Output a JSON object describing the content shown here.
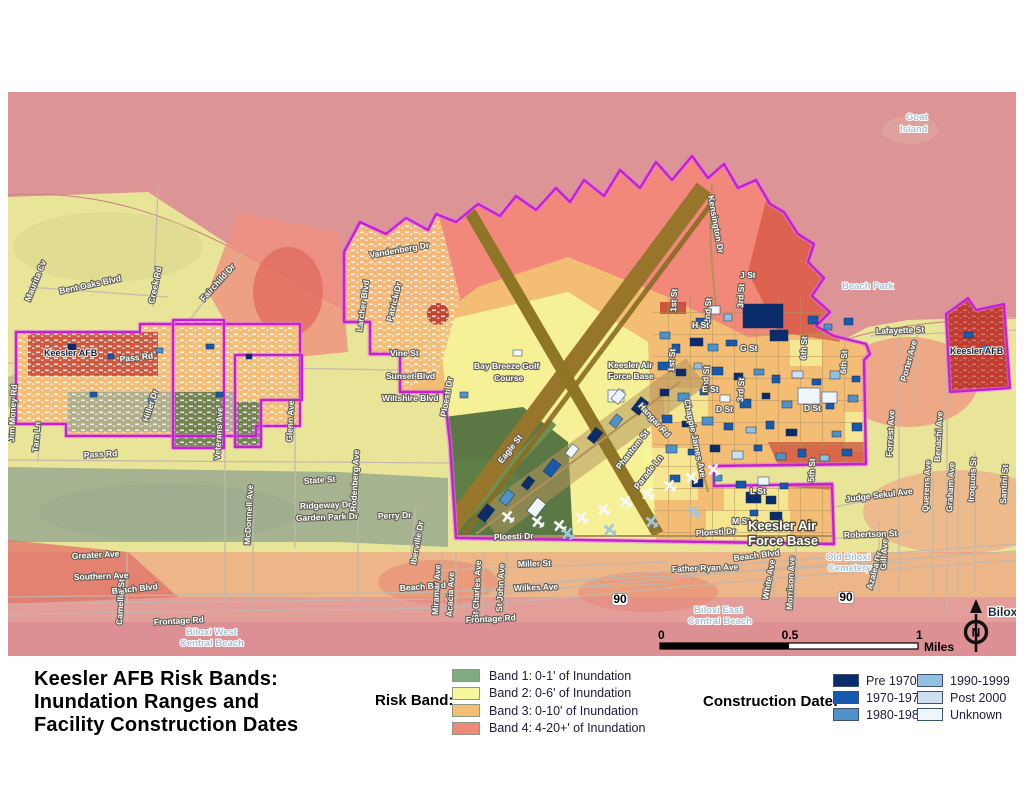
{
  "title": {
    "lines": [
      "Keesler AFB Risk Bands:",
      "Inundation Ranges and",
      "Facility Construction Dates"
    ]
  },
  "risk_band_legend": {
    "label": "Risk Band:",
    "items": [
      {
        "label": "Band 1:",
        "desc": "0-1' of Inundation",
        "color": "#7eac81"
      },
      {
        "label": "Band 2:",
        "desc": "0-6' of Inundation",
        "color": "#f6f69b"
      },
      {
        "label": "Band 3:",
        "desc": "0-10' of Inundation",
        "color": "#f4bd74"
      },
      {
        "label": "Band 4:",
        "desc": "4-20+' of Inundation",
        "color": "#f2887a"
      }
    ]
  },
  "construction_legend": {
    "label": "Construction Date:",
    "items": [
      {
        "label": "Pre 1970",
        "color": "#0b2c6b"
      },
      {
        "label": "1970-1979",
        "color": "#1759ac"
      },
      {
        "label": "1980-1989",
        "color": "#4e92c9"
      },
      {
        "label": "1990-1999",
        "color": "#92c0e0"
      },
      {
        "label": "Post 2000",
        "color": "#cddff0"
      },
      {
        "label": "Unknown",
        "color": "#eff5fc"
      }
    ]
  },
  "scale_bar": {
    "ticks": [
      "0",
      "0.5",
      "1"
    ],
    "unit": "Miles"
  },
  "north_arrow": {
    "letter": "N"
  },
  "colors": {
    "water": "#dc9494",
    "terrain": "#e9e598",
    "terrainGreen": "#99aa8e",
    "salmon": "#ef8f7d",
    "beach": "#e49e9a",
    "beachDeep": "#dd9094",
    "band1": "#7eac81",
    "band2": "#f6f69b",
    "band3": "#f4bd74",
    "band4": "#f2887a",
    "era1": "#0b2c6b",
    "era2": "#1759ac",
    "era3": "#4e92c9",
    "era4": "#92c0e0",
    "era5": "#cddff0",
    "era6": "#eff5fc",
    "boundary": "#c520d0",
    "runway": "#97762b",
    "roadTan": "#b1905c",
    "roadGray": "#c3b7ac",
    "golf": "#52713f",
    "parcelRed": "#c03a2e",
    "aircraft": "#f5f8fb",
    "aircraftBlue": "#9ec7e4"
  },
  "map": {
    "shield_label": "90",
    "labels": [
      [
        "Maurita Cv",
        22,
        210,
        -68
      ],
      [
        "Bent Oaks Blvd",
        52,
        202,
        -12
      ],
      [
        "Creek Rd",
        146,
        212,
        -78
      ],
      [
        "Fairchild Dr",
        196,
        210,
        -48
      ],
      [
        "Pass Rd",
        112,
        270,
        -6
      ],
      [
        "Hiller Dr",
        140,
        330,
        -72
      ],
      [
        "Veterans Ave",
        212,
        368,
        -87
      ],
      [
        "Tara Ln",
        30,
        360,
        -85
      ],
      [
        "Pass Rd",
        76,
        366,
        -3
      ],
      [
        "Jim Money Rd",
        6,
        350,
        -87
      ],
      [
        "Glenn Ave",
        284,
        350,
        -87
      ],
      [
        "Vine St",
        382,
        264,
        0
      ],
      [
        "Sunset Blvd",
        378,
        287,
        0
      ],
      [
        "Wiltshire Blvd",
        374,
        309,
        0
      ],
      [
        "Vandenberg Dr",
        362,
        166,
        -10
      ],
      [
        "Patrick Dr",
        384,
        230,
        -76
      ],
      [
        "Larcher Blvd",
        354,
        240,
        -82
      ],
      [
        "Bay Breeze Golf",
        466,
        277,
        0,
        "st",
        9
      ],
      [
        "Course",
        486,
        289,
        0,
        "st",
        9
      ],
      [
        "Ploesti Dr",
        438,
        325,
        -80
      ],
      [
        "Ploesti Dr",
        486,
        448,
        -2
      ],
      [
        "Ploesti Dr",
        688,
        444,
        -3
      ],
      [
        "Eagle St",
        494,
        372,
        -52
      ],
      [
        "Phantom St",
        612,
        378,
        -52
      ],
      [
        "Parade Ln",
        630,
        398,
        -52
      ],
      [
        "Hangar Rd",
        630,
        314,
        48
      ],
      [
        "Chappie James Ave",
        676,
        308,
        78
      ],
      [
        "Kensington Dr",
        700,
        104,
        80
      ],
      [
        "1st St",
        668,
        220,
        -87
      ],
      [
        "1st St",
        666,
        280,
        -87
      ],
      [
        "2nd St",
        702,
        232,
        -87
      ],
      [
        "2nd St",
        700,
        300,
        -87
      ],
      [
        "3rd St",
        735,
        216,
        -87
      ],
      [
        "3rd St",
        735,
        310,
        -87
      ],
      [
        "J St",
        732,
        186,
        0
      ],
      [
        "H St",
        684,
        236,
        0
      ],
      [
        "G St",
        732,
        259,
        0
      ],
      [
        "E St",
        694,
        300,
        0
      ],
      [
        "D St",
        708,
        320,
        0
      ],
      [
        "D St",
        796,
        319,
        0
      ],
      [
        "6th St",
        798,
        268,
        -87
      ],
      [
        "6th St",
        838,
        282,
        -87
      ],
      [
        "5th St",
        806,
        390,
        -87
      ],
      [
        "L St",
        742,
        402,
        0
      ],
      [
        "M St",
        724,
        432,
        0
      ],
      [
        "Keesler Air",
        600,
        276,
        0,
        "st",
        8
      ],
      [
        "Force Base",
        600,
        287,
        0,
        "st",
        8
      ],
      [
        "Keesler Air",
        740,
        438,
        0,
        "big"
      ],
      [
        "Force Base",
        740,
        453,
        0,
        "big"
      ],
      [
        "Lafayette St",
        868,
        242,
        -2
      ],
      [
        "Goat",
        898,
        28,
        0,
        "place"
      ],
      [
        "Island",
        892,
        40,
        0,
        "place"
      ],
      [
        "Beach Park",
        834,
        197,
        0,
        "place"
      ],
      [
        "Porter Ave",
        898,
        290,
        -75
      ],
      [
        "Forrest Ave",
        884,
        365,
        -87
      ],
      [
        "Benachi Ave",
        932,
        370,
        -87
      ],
      [
        "Keesler AFB",
        942,
        262,
        0,
        "dark"
      ],
      [
        "Keesler AFB",
        36,
        264,
        0,
        "dark"
      ],
      [
        "Judge Sekul Ave",
        838,
        410,
        -7
      ],
      [
        "Robertson St",
        836,
        446,
        -2
      ],
      [
        "Old Biloxi",
        818,
        468,
        0,
        "place"
      ],
      [
        "Cemetery",
        820,
        479,
        0,
        "place"
      ],
      [
        "Father Ryan Ave",
        664,
        480,
        -2
      ],
      [
        "White Ave",
        760,
        508,
        -80
      ],
      [
        "Morrison Ave",
        784,
        518,
        -87
      ],
      [
        "Azalea Dr",
        864,
        498,
        -75
      ],
      [
        "Gill Ave",
        878,
        478,
        -87
      ],
      [
        "Beach Blvd",
        104,
        502,
        -6
      ],
      [
        "Beach Blvd",
        392,
        499,
        -4
      ],
      [
        "Beach Blvd",
        726,
        469,
        -7
      ],
      [
        "Miller St",
        510,
        475,
        -2
      ],
      [
        "Wilkes Ave",
        506,
        499,
        -2
      ],
      [
        "Miramar Ave",
        430,
        523,
        -87
      ],
      [
        "Acacia Ave",
        444,
        525,
        -87
      ],
      [
        "St Charles Ave",
        470,
        528,
        -87
      ],
      [
        "St John Ave",
        494,
        520,
        -87
      ],
      [
        "Iberville Dr",
        408,
        473,
        -80
      ],
      [
        "Rodenberg Ave",
        348,
        420,
        -87
      ],
      [
        "McDonnell Ave",
        242,
        453,
        -87
      ],
      [
        "State St",
        296,
        392,
        -4
      ],
      [
        "Ridgeway Dr",
        292,
        417,
        -2
      ],
      [
        "Garden Park Dr",
        288,
        429,
        -2
      ],
      [
        "Perry Dr",
        370,
        427,
        -2
      ],
      [
        "Greater Ave",
        64,
        467,
        -3
      ],
      [
        "Southern Ave",
        66,
        488,
        -2
      ],
      [
        "Camellia St",
        114,
        533,
        -87
      ],
      [
        "Frontage Rd",
        146,
        533,
        -3
      ],
      [
        "Frontage Rd",
        458,
        531,
        -3
      ],
      [
        "Biloxi West",
        178,
        543,
        0,
        "place"
      ],
      [
        "Central Beach",
        172,
        554,
        0,
        "place"
      ],
      [
        "Biloxi East",
        686,
        521,
        0,
        "place"
      ],
      [
        "Central Beach",
        680,
        532,
        0,
        "place"
      ],
      [
        "Biloxi",
        980,
        524,
        0,
        "city"
      ],
      [
        "Iroquois St",
        966,
        410,
        -87
      ],
      [
        "Graham Ave",
        944,
        420,
        -87
      ],
      [
        "Querens Ave",
        920,
        420,
        -87
      ],
      [
        "Santini St",
        998,
        412,
        -87
      ]
    ],
    "buildings": [
      [
        735,
        212,
        40,
        24,
        1
      ],
      [
        762,
        238,
        18,
        11,
        1
      ],
      [
        700,
        214,
        12,
        8,
        6
      ],
      [
        716,
        222,
        8,
        7,
        4
      ],
      [
        688,
        226,
        10,
        7,
        2
      ],
      [
        652,
        240,
        10,
        7,
        3
      ],
      [
        664,
        252,
        8,
        9,
        2
      ],
      [
        682,
        246,
        13,
        8,
        1
      ],
      [
        700,
        252,
        10,
        7,
        3
      ],
      [
        718,
        248,
        11,
        6,
        2
      ],
      [
        800,
        224,
        10,
        8,
        2
      ],
      [
        816,
        232,
        8,
        6,
        3
      ],
      [
        836,
        226,
        9,
        7,
        2
      ],
      [
        650,
        270,
        11,
        8,
        2
      ],
      [
        668,
        277,
        10,
        7,
        1
      ],
      [
        686,
        271,
        8,
        6,
        4
      ],
      [
        704,
        275,
        11,
        8,
        2
      ],
      [
        726,
        281,
        9,
        7,
        1
      ],
      [
        746,
        277,
        10,
        6,
        3
      ],
      [
        764,
        283,
        8,
        8,
        2
      ],
      [
        784,
        279,
        11,
        7,
        5
      ],
      [
        804,
        287,
        9,
        6,
        2
      ],
      [
        822,
        279,
        10,
        8,
        4
      ],
      [
        844,
        284,
        8,
        6,
        2
      ],
      [
        652,
        297,
        9,
        7,
        1
      ],
      [
        670,
        301,
        11,
        8,
        3
      ],
      [
        692,
        297,
        8,
        6,
        2
      ],
      [
        712,
        303,
        10,
        7,
        6
      ],
      [
        732,
        307,
        11,
        9,
        2
      ],
      [
        754,
        301,
        8,
        6,
        1
      ],
      [
        774,
        309,
        10,
        7,
        3
      ],
      [
        796,
        303,
        13,
        10,
        5
      ],
      [
        818,
        311,
        8,
        6,
        2
      ],
      [
        840,
        303,
        10,
        7,
        3
      ],
      [
        654,
        323,
        10,
        8,
        2
      ],
      [
        674,
        329,
        8,
        6,
        1
      ],
      [
        694,
        325,
        11,
        8,
        3
      ],
      [
        716,
        331,
        9,
        7,
        2
      ],
      [
        738,
        335,
        10,
        6,
        4
      ],
      [
        758,
        329,
        8,
        8,
        2
      ],
      [
        778,
        337,
        11,
        7,
        1
      ],
      [
        790,
        296,
        22,
        16,
        6
      ],
      [
        814,
        300,
        15,
        11,
        6
      ],
      [
        824,
        339,
        9,
        6,
        3
      ],
      [
        844,
        331,
        10,
        8,
        2
      ],
      [
        658,
        353,
        11,
        8,
        3
      ],
      [
        680,
        357,
        8,
        6,
        2
      ],
      [
        702,
        353,
        10,
        7,
        1
      ],
      [
        724,
        359,
        11,
        8,
        5
      ],
      [
        746,
        353,
        8,
        6,
        2
      ],
      [
        768,
        361,
        10,
        7,
        3
      ],
      [
        790,
        357,
        8,
        8,
        2
      ],
      [
        812,
        363,
        9,
        6,
        4
      ],
      [
        834,
        357,
        10,
        7,
        2
      ],
      [
        662,
        383,
        10,
        7,
        2
      ],
      [
        684,
        387,
        11,
        8,
        1
      ],
      [
        706,
        383,
        8,
        6,
        3
      ],
      [
        728,
        389,
        10,
        7,
        2
      ],
      [
        750,
        385,
        11,
        8,
        6
      ],
      [
        772,
        391,
        8,
        6,
        2
      ],
      [
        738,
        400,
        15,
        11,
        1
      ],
      [
        758,
        404,
        10,
        8,
        1
      ],
      [
        742,
        418,
        8,
        6,
        2
      ],
      [
        762,
        420,
        12,
        8,
        1
      ],
      [
        600,
        298,
        16,
        12,
        6
      ],
      [
        470,
        416,
        16,
        10,
        1,
        -52
      ],
      [
        492,
        401,
        14,
        9,
        3,
        -52
      ],
      [
        514,
        387,
        12,
        8,
        1,
        -52
      ],
      [
        536,
        371,
        16,
        10,
        2,
        -52
      ],
      [
        558,
        355,
        12,
        8,
        6,
        -52
      ],
      [
        580,
        339,
        14,
        9,
        1,
        -52
      ],
      [
        602,
        325,
        12,
        8,
        3,
        -52
      ],
      [
        624,
        309,
        16,
        10,
        1,
        -52
      ],
      [
        520,
        410,
        17,
        11,
        6,
        -52
      ],
      [
        604,
        300,
        13,
        9,
        6,
        -52
      ],
      [
        60,
        252,
        8,
        6,
        1
      ],
      [
        100,
        262,
        6,
        5,
        2
      ],
      [
        148,
        256,
        7,
        5,
        3
      ],
      [
        198,
        252,
        8,
        5,
        2
      ],
      [
        238,
        262,
        6,
        5,
        1
      ],
      [
        82,
        300,
        7,
        5,
        2
      ],
      [
        140,
        306,
        6,
        4,
        3
      ],
      [
        208,
        300,
        7,
        5,
        2
      ],
      [
        956,
        240,
        9,
        6,
        2
      ],
      [
        974,
        254,
        7,
        5,
        3
      ],
      [
        452,
        300,
        8,
        6,
        3
      ],
      [
        505,
        258,
        9,
        6,
        6
      ]
    ],
    "aircraft": [
      [
        500,
        425,
        -52,
        0
      ],
      [
        530,
        430,
        -52,
        0
      ],
      [
        552,
        434,
        -52,
        0
      ],
      [
        574,
        426,
        -52,
        0
      ],
      [
        596,
        418,
        -52,
        0
      ],
      [
        618,
        410,
        -52,
        0
      ],
      [
        640,
        402,
        -52,
        0
      ],
      [
        662,
        394,
        -52,
        0
      ],
      [
        684,
        386,
        -52,
        0
      ],
      [
        706,
        378,
        -52,
        0
      ],
      [
        560,
        442,
        -52,
        1
      ],
      [
        602,
        438,
        -52,
        1
      ],
      [
        644,
        430,
        -52,
        1
      ],
      [
        686,
        420,
        -52,
        1
      ]
    ]
  }
}
